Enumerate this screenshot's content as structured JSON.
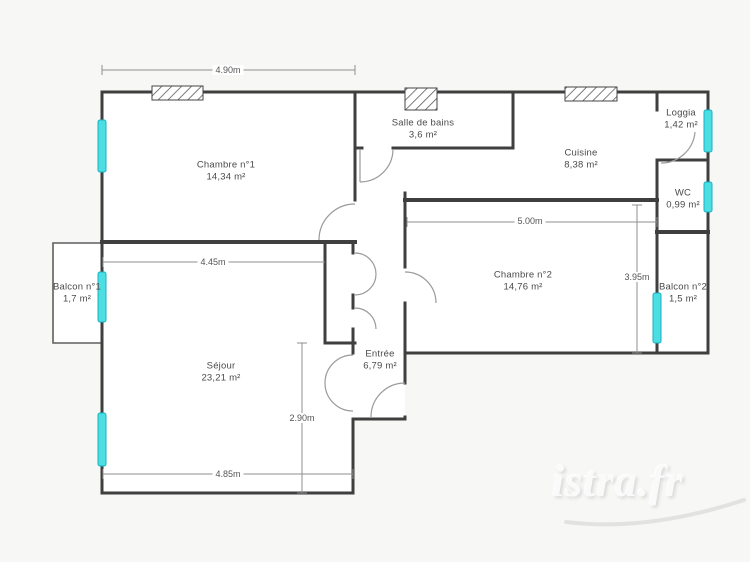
{
  "watermark": {
    "text": "istra.fr"
  },
  "rooms": [
    {
      "id": "chambre-1",
      "name": "Chambre n°1",
      "area": "14,34 m²"
    },
    {
      "id": "salle-de-bains",
      "name": "Salle de bains",
      "area": "3,6 m²"
    },
    {
      "id": "cuisine",
      "name": "Cuisine",
      "area": "8,38 m²"
    },
    {
      "id": "loggia",
      "name": "Loggia",
      "area": "1,42 m²"
    },
    {
      "id": "wc",
      "name": "WC",
      "area": "0,99 m²"
    },
    {
      "id": "balcon-1",
      "name": "Balcon n°1",
      "area": "1,7 m²"
    },
    {
      "id": "chambre-2",
      "name": "Chambre n°2",
      "area": "14,76 m²"
    },
    {
      "id": "balcon-2",
      "name": "Balcon n°2",
      "area": "1,5 m²"
    },
    {
      "id": "sejour",
      "name": "Séjour",
      "area": "23,21 m²"
    },
    {
      "id": "entree",
      "name": "Entrée",
      "area": "6,79 m²"
    }
  ],
  "dimensions": [
    {
      "id": "chambre1-top-width",
      "value": "4.90m"
    },
    {
      "id": "sejour-top-width",
      "value": "4.45m"
    },
    {
      "id": "chambre2-width",
      "value": "5.00m"
    },
    {
      "id": "chambre2-height",
      "value": "3.95m"
    },
    {
      "id": "sejour-height",
      "value": "2.90m"
    },
    {
      "id": "sejour-bottom-width",
      "value": "4.85m"
    }
  ],
  "colors": {
    "wall": "#3f3f3f",
    "thin_line": "#8f8f8f",
    "window_marker": "#4cdee2",
    "window_border": "#17b3c0",
    "background": "#f7f7f5",
    "room_fill": "#ffffff"
  }
}
